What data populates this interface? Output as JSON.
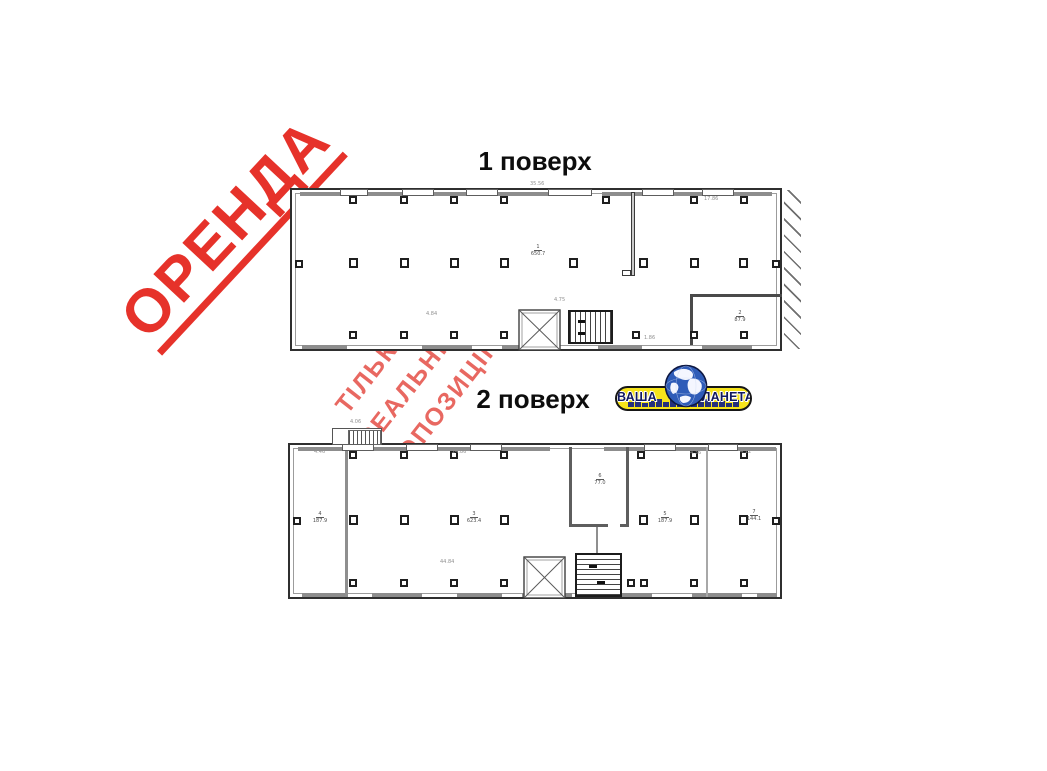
{
  "stamp": {
    "text": "ОРЕНДА"
  },
  "watermark": {
    "lines": [
      "ТІЛЬКИ",
      "РЕАЛЬНІ",
      "ПРОПОЗИЦІЇ"
    ]
  },
  "floor1": {
    "title": "1 поверх",
    "rooms": [
      {
        "num": "1",
        "area": "650.7"
      },
      {
        "num": "2",
        "area": "87.9"
      }
    ],
    "dims": [
      "35.56",
      "17.86",
      "4.84",
      "1.86",
      "4.75"
    ]
  },
  "floor2": {
    "title": "2 поверх",
    "rooms": [
      {
        "num": "4",
        "area": "187.9"
      },
      {
        "num": "3",
        "area": "623.4"
      },
      {
        "num": "6",
        "area": "77.0"
      },
      {
        "num": "5",
        "area": "187.9"
      },
      {
        "num": "7",
        "area": "144.1"
      }
    ],
    "dims": [
      "4.06",
      "4.46",
      "24.86",
      "4.36",
      "4.12",
      "44.84"
    ]
  },
  "logo": {
    "text": "ВАША ПЛАНЕТА"
  },
  "colors": {
    "stamp_red": "#e6322a",
    "watermark_red": "#e14b40",
    "logo_yellow": "#f6e41b",
    "logo_navy": "#121a5e",
    "globe_blue": "#2f5cb8",
    "wall_dark": "#2f2f2f",
    "wall_gray": "#8d8d8d"
  }
}
